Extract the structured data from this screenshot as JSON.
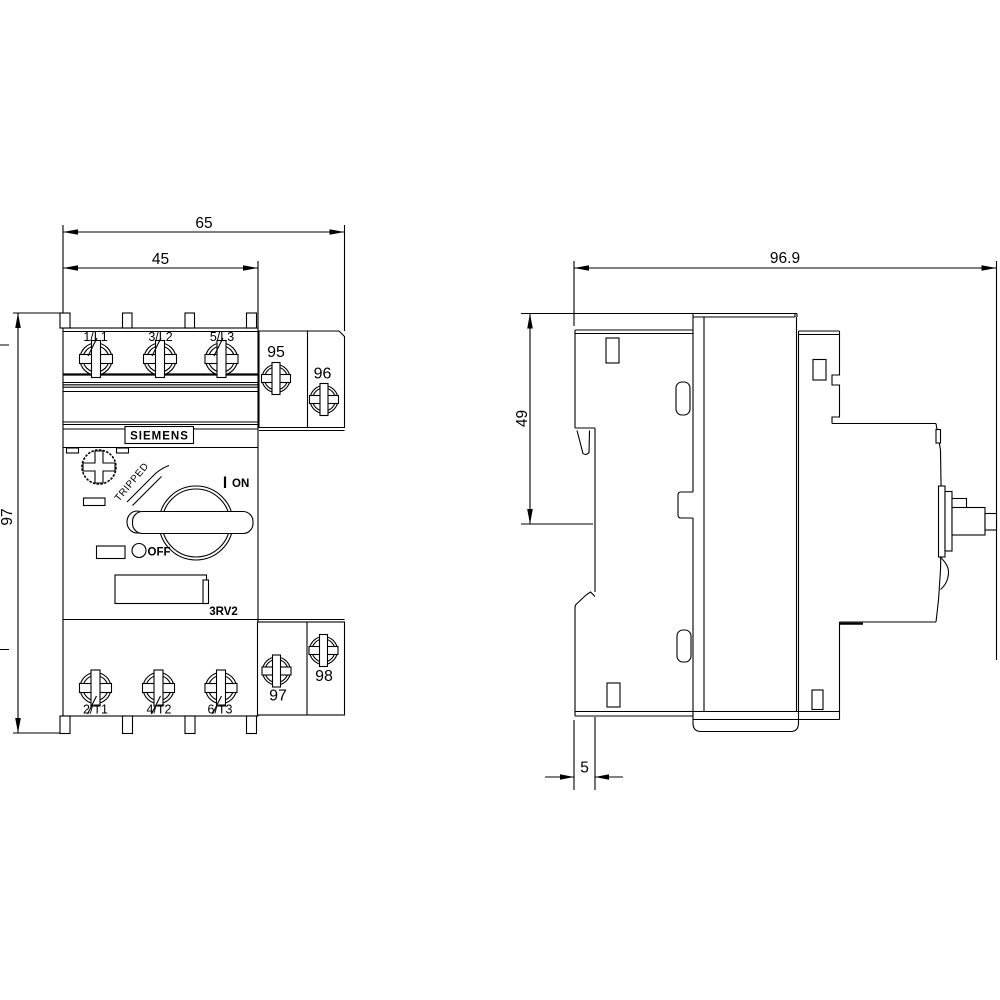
{
  "drawing": {
    "brand": "SIEMENS",
    "model": "3RV2",
    "views": {
      "front": {
        "dims": {
          "width_total": "65",
          "width_body": "45",
          "height": "97"
        },
        "terminals_top": [
          "1/L1",
          "3/L2",
          "5/L3"
        ],
        "terminals_bottom": [
          "2/T1",
          "4/T2",
          "6/T3"
        ],
        "aux_contacts": {
          "top_left": "95",
          "top_right": "96",
          "bottom_left": "97",
          "bottom_right": "98"
        },
        "switch": {
          "on_symbol": "|",
          "on": "ON",
          "off": "OFF",
          "tripped": "TRIPPED"
        }
      },
      "side": {
        "dims": {
          "depth_total": "96.9",
          "height_upper": "49",
          "din_clip_offset": "5"
        }
      }
    },
    "colors": {
      "line": "#000000",
      "background": "#ffffff"
    }
  }
}
